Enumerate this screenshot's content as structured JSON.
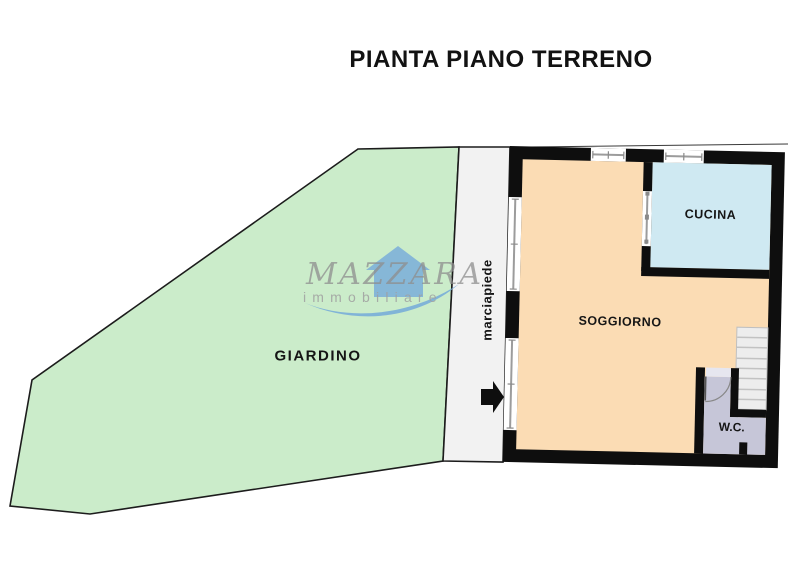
{
  "title": "PIANTA PIANO TERRENO",
  "watermark": {
    "brand": "MAZZARA",
    "subtitle": "immobiliare"
  },
  "floorplan": {
    "rooms": [
      {
        "id": "giardino",
        "label": "GIARDINO"
      },
      {
        "id": "marciapiede",
        "label": "marciapiede"
      },
      {
        "id": "soggiorno",
        "label": "SOGGIORNO"
      },
      {
        "id": "cucina",
        "label": "CUCINA"
      },
      {
        "id": "wc",
        "label": "W.C."
      }
    ],
    "colors": {
      "garden": "#cbecca",
      "sidewalk": "#f2f2f2",
      "living": "#fbdcb4",
      "kitchen": "#cfe9f2",
      "wc": "#c6c6d8",
      "stairs": "#ededed",
      "wall": "#0e0e0e",
      "watermark_blue": "#74aad9",
      "watermark_grey": "#8e8e8e"
    }
  }
}
